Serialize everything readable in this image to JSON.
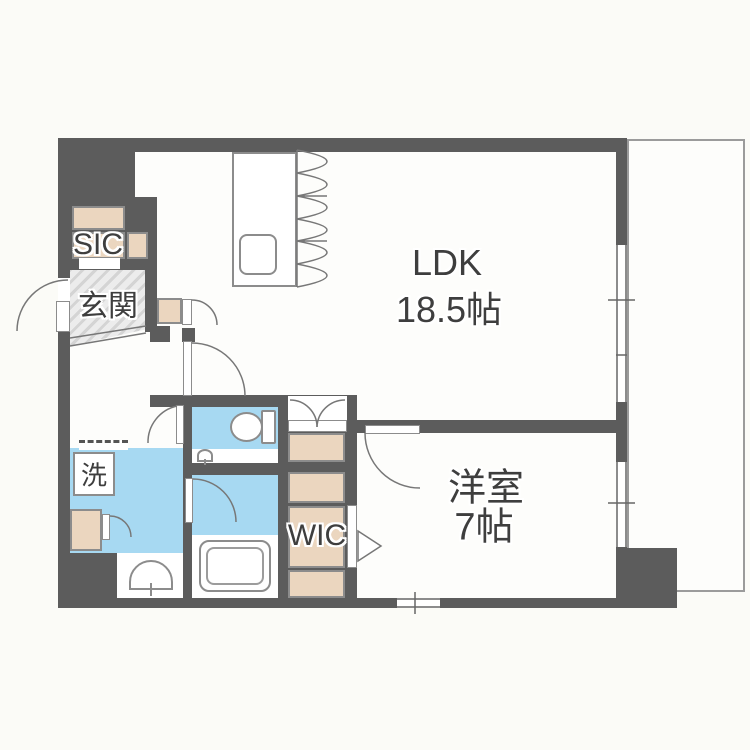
{
  "plan": {
    "rooms": {
      "ldk": {
        "label": "LDK",
        "size": "18.5帖"
      },
      "western_room": {
        "label": "洋室",
        "size": "7帖"
      },
      "entrance": {
        "label": "玄関"
      },
      "shoe_closet": {
        "label": "SIC"
      },
      "walk_in_closet": {
        "label": "WIC"
      },
      "laundry": {
        "label": "洗"
      }
    },
    "colors": {
      "wall": "#5c5c5c",
      "wet_area": "#a7d9f2",
      "storage": "#ebd6bf",
      "entrance_floor": "#dcdcdc",
      "fixture_line": "#8c8c8c"
    }
  }
}
